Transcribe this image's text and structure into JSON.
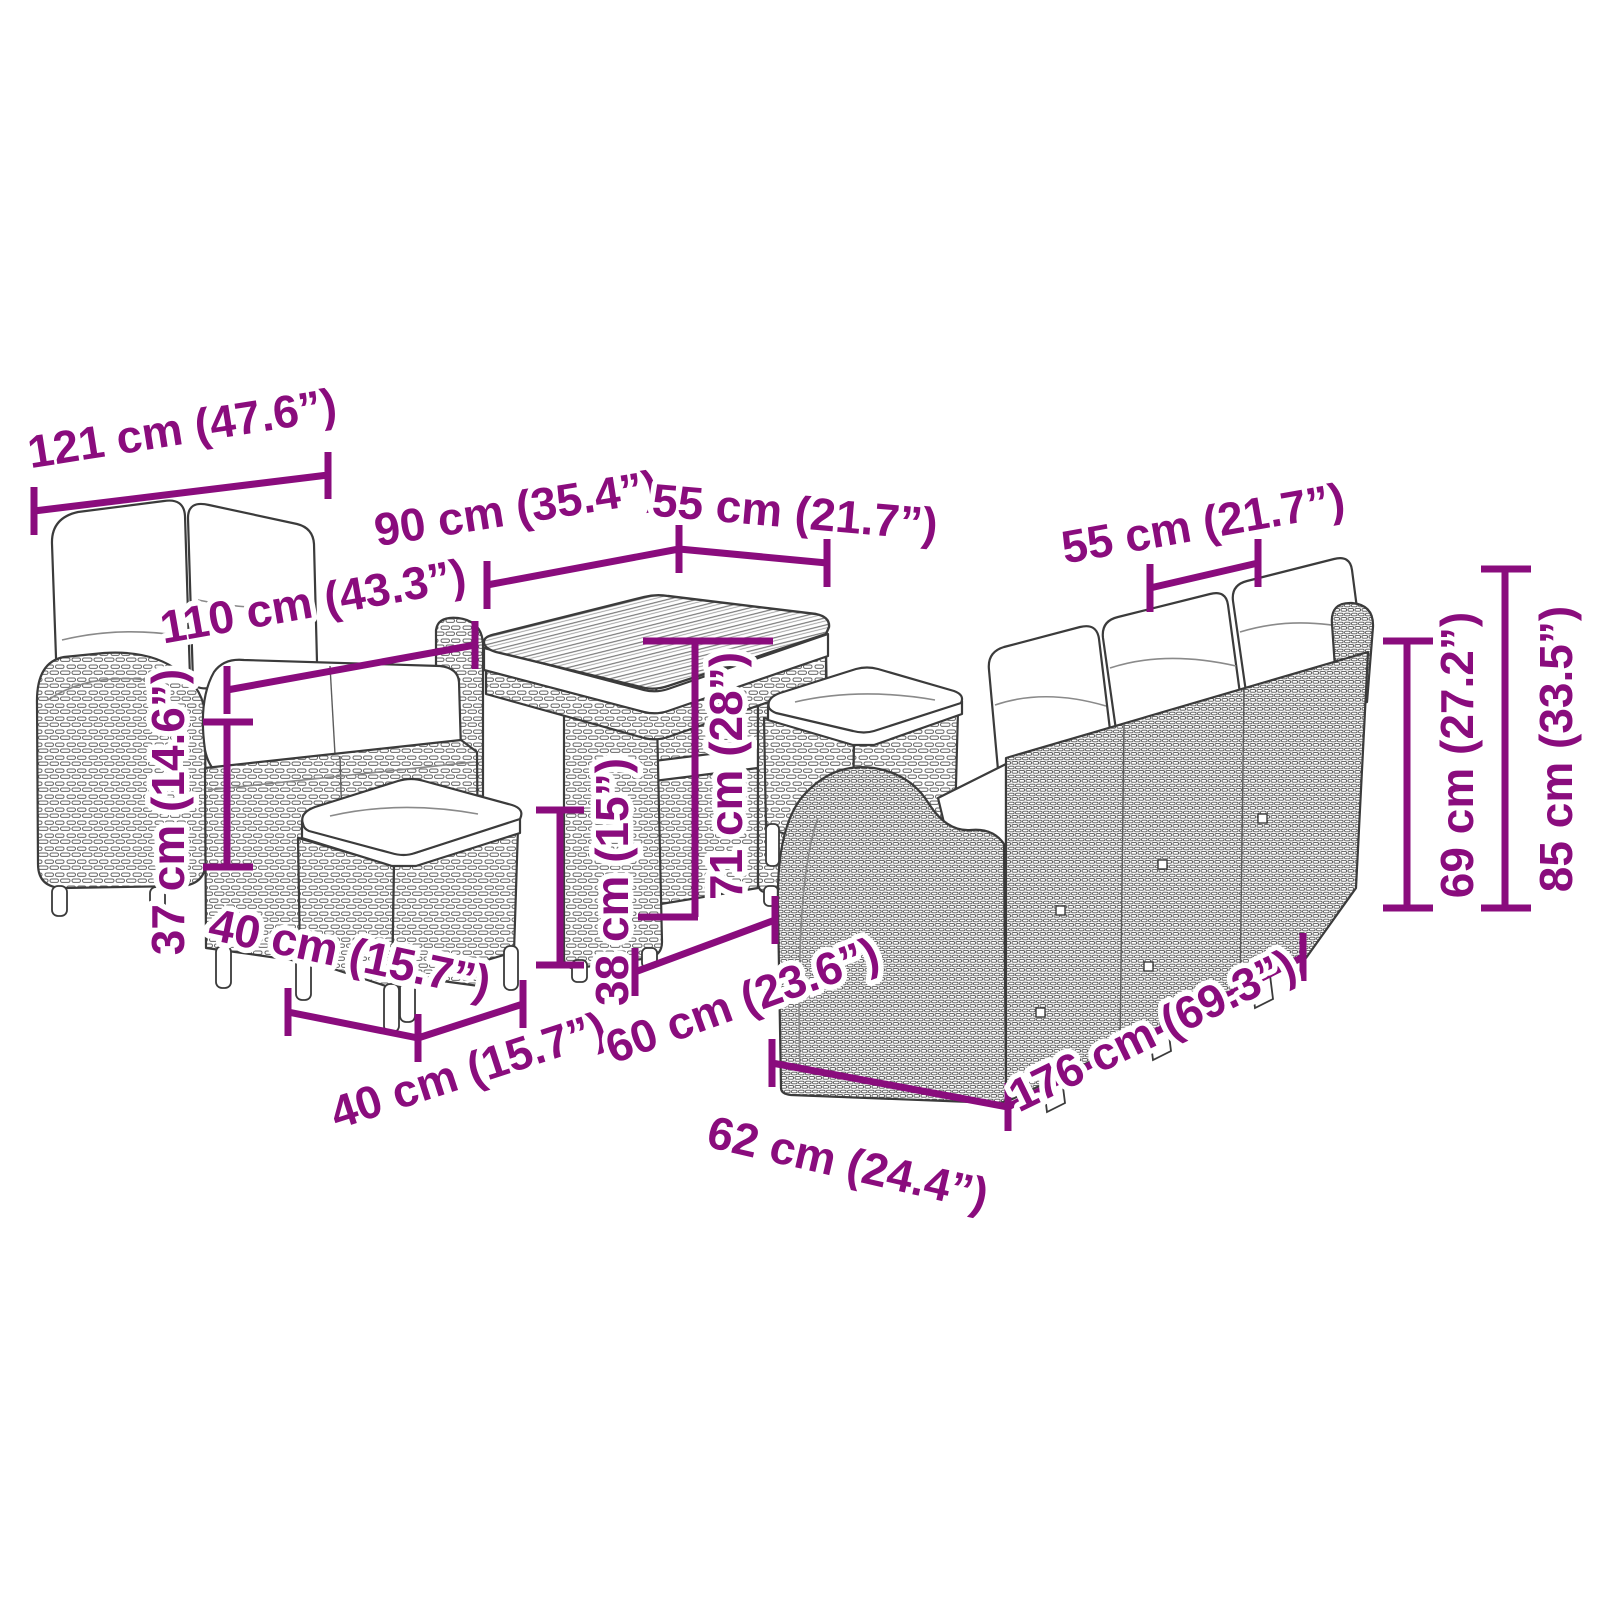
{
  "meta": {
    "title": "Garden furniture set dimension diagram",
    "background_color": "#ffffff",
    "accent_color": "#8A0C7D",
    "line_art_color": "#3b3b3b",
    "units": "cm (inches)"
  },
  "furniture": {
    "left_sofa": "2-seater garden sofa with back and seat cushions",
    "table": "Garden table with slatted top",
    "stool_front": "Garden stool with cushion",
    "stool_rear": "Garden stool with cushion",
    "right_sofa": "3-seater garden sofa with back cushions"
  },
  "dimensions": [
    {
      "id": "sofa2-width",
      "cm": 121,
      "inches": 47.6,
      "label": "121 cm (47.6”)"
    },
    {
      "id": "table-length",
      "cm": 90,
      "inches": 35.4,
      "label": "90 cm (35.4”)"
    },
    {
      "id": "table-depth",
      "cm": 55,
      "inches": 21.7,
      "label": "55 cm (21.7”)"
    },
    {
      "id": "sofa2-seat-width",
      "cm": 110,
      "inches": 43.3,
      "label": "110 cm (43.3”)"
    },
    {
      "id": "sofa2-seat-height",
      "cm": 37,
      "inches": 14.6,
      "label": "37 cm (14.6”)"
    },
    {
      "id": "stool-width",
      "cm": 40,
      "inches": 15.7,
      "label": "40 cm (15.7”)"
    },
    {
      "id": "stool-depth",
      "cm": 40,
      "inches": 15.7,
      "label": "40 cm (15.7”)"
    },
    {
      "id": "stool-height",
      "cm": 38,
      "inches": 15,
      "label": "38 cm (15”)"
    },
    {
      "id": "table-height",
      "cm": 71,
      "inches": 28,
      "label": "71 cm (28”)"
    },
    {
      "id": "table-base-depth",
      "cm": 60,
      "inches": 23.6,
      "label": "60 cm (23.6”)"
    },
    {
      "id": "sofa3-depth",
      "cm": 62,
      "inches": 24.4,
      "label": "62 cm (24.4”)"
    },
    {
      "id": "sofa3-width",
      "cm": 176,
      "inches": 69.3,
      "label": "176 cm (69.3”)"
    },
    {
      "id": "sofa3-seat-width",
      "cm": 55,
      "inches": 21.7,
      "label": "55 cm (21.7”)"
    },
    {
      "id": "sofa3-back-height",
      "cm": 69,
      "inches": 27.2,
      "label": "69 cm (27.2”)"
    },
    {
      "id": "sofa3-total-height",
      "cm": 85,
      "inches": 33.5,
      "label": "85 cm (33.5”)"
    }
  ]
}
